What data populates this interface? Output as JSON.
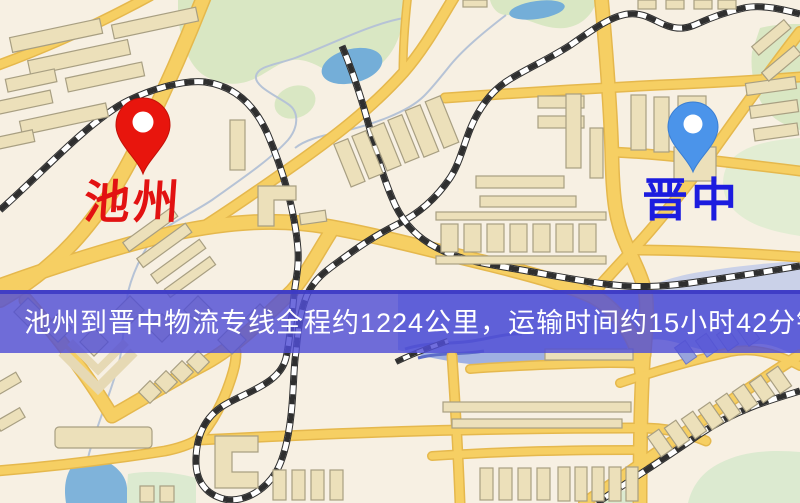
{
  "map": {
    "type": "road-map",
    "banner": {
      "text": "池州到晋中物流专线全程约1224公里，运输时间约15小时42分钟.",
      "background_color": "#504ed5",
      "text_color": "#ffffff",
      "route": {
        "from": "池州",
        "to": "晋中",
        "distance_km": "1224",
        "duration": "15小时42分钟"
      }
    },
    "markers": [
      {
        "id": "origin",
        "label": "池州",
        "pin_color": "#e8150d",
        "label_color": "#e21212"
      },
      {
        "id": "destination",
        "label": "晋中",
        "pin_color": "#4b94ea",
        "label_color": "#1c1cdf"
      }
    ],
    "palette": {
      "land": "#f7f0e3",
      "park": "#d9e7c3",
      "water": "#74aed8",
      "water_band": "#9fb0e2",
      "road": "#f6cf63",
      "road_casing": "#e5b84d",
      "railway": "#2f2f2f",
      "building": "#ece0ba",
      "building_outline": "#a89f82"
    }
  }
}
